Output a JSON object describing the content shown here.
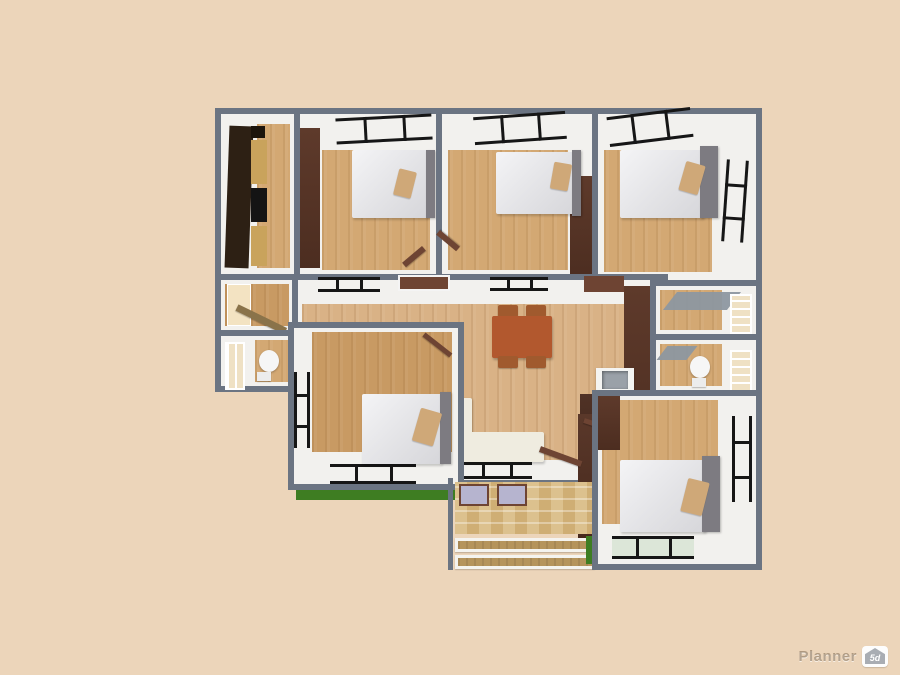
{
  "app": {
    "watermark_brand": "Planner",
    "watermark_badge": "5d"
  },
  "colors": {
    "background": "#ecd5ba",
    "wall": "#6b7482",
    "room_white": "#f2f1ee",
    "floor_wood": "#d3a873",
    "floor_wood_dark": "#c89a63",
    "floor_living": "#d9b286",
    "floor_porch": "#cfae74",
    "accent_brown": "#5e3a2b",
    "door_brown": "#6e4433",
    "door_cream": "#f3e3c2",
    "table_terracotta": "#b2582e",
    "chair_brown": "#a05a2e",
    "pillow_tan": "#cfa878",
    "headboard_gray": "#7d7b81",
    "sofa_cream": "#efece0",
    "grass_green": "#3e7d22",
    "window_black": "#161616",
    "shutter_cream": "#efe1c4",
    "lavender": "#b6b4cf",
    "sink_gray": "#9aa1a8",
    "cabinet_dark": "#2d2014",
    "counter_tan": "#c9a35c",
    "step_wood": "#b5945c",
    "awning_gray": "#8d97a0"
  },
  "scene": {
    "type": "3d-floor-plan-render",
    "rooms": [
      {
        "name": "kitchen",
        "furniture": [
          "kitchen-cabinets",
          "countertop",
          "stove"
        ]
      },
      {
        "name": "bedroom-top-left",
        "furniture": [
          "double-bed",
          "pillow",
          "north-window",
          "accent-wall"
        ]
      },
      {
        "name": "bedroom-top-middle",
        "furniture": [
          "double-bed",
          "pillow",
          "north-window",
          "accent-wall"
        ]
      },
      {
        "name": "bedroom-top-right",
        "furniture": [
          "double-bed",
          "pillow",
          "north-window",
          "east-window",
          "headboard"
        ]
      },
      {
        "name": "hallway-left",
        "furniture": [
          "entry-door"
        ]
      },
      {
        "name": "bathroom-left",
        "furniture": [
          "toilet",
          "shutter-window"
        ]
      },
      {
        "name": "living-dining-room",
        "furniture": [
          "dining-table",
          "chair",
          "chair",
          "chair",
          "chair",
          "sofa",
          "sink-vanity",
          "accent-wall",
          "doors",
          "windows"
        ]
      },
      {
        "name": "storage-right",
        "furniture": [
          "shutter-window",
          "awning"
        ]
      },
      {
        "name": "bathroom-right",
        "furniture": [
          "toilet",
          "shutter-window"
        ]
      },
      {
        "name": "bedroom-bottom-left",
        "furniture": [
          "double-bed",
          "pillow",
          "west-window",
          "south-window",
          "grass-strip"
        ]
      },
      {
        "name": "porch-entry",
        "furniture": [
          "parquet-floor",
          "lavender-windows",
          "steps",
          "entry-door"
        ]
      },
      {
        "name": "bedroom-bottom-right",
        "furniture": [
          "double-bed",
          "pillow",
          "east-window",
          "south-window",
          "grass-patch"
        ]
      }
    ]
  }
}
